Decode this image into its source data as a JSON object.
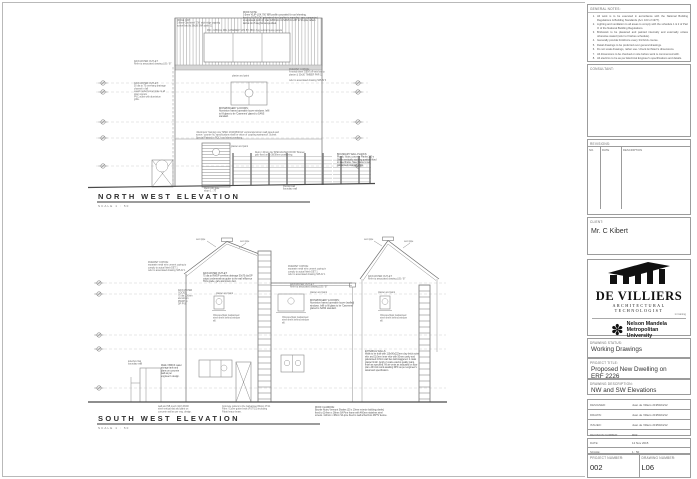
{
  "general_notes": {
    "title": "GENERAL NOTES:",
    "items": [
      "All work is to be executed in accordance with the National Building Regulations & Building Standards (Act. 103 of 1977).",
      "Lighting and ventilation to all areas to comply with the schedule 1 & 2 of Part O of the National Building Regulations.",
      "Brickwork to be plastered and painted internally and externally unless otherwise stated (refer to finishes schedule).",
      "Generally provide brickforce every 3rd brick course.",
      "Detail drawings to be preferred over general drawings.",
      "Do not scale drawings, rather use / check Architect's dimensions.",
      "All dimensions to be checked on site before work is commenced with.",
      "All electrics to be as per Electrical Engineer's specifications and details."
    ]
  },
  "consultant_label": "CONSULTANT:",
  "revisions": {
    "label": "REVISIONS:",
    "columns": [
      "NO.",
      "DATE",
      "DESCRIPTION"
    ]
  },
  "client": {
    "label": "CLIENT:",
    "name": "Mr. C Kibert"
  },
  "firm": {
    "name": "DE VILLIERS",
    "subtitle": "ARCHITECTURAL TECHNOLOGIST",
    "tagline": "in training"
  },
  "university": {
    "line1": "Nelson Mandela",
    "line2": "Metropolitan",
    "line3": "University",
    "motto": "for tomorrow",
    "icon": "flower-star"
  },
  "status": {
    "label": "DRAWING STATUS:",
    "value": "Working Drawings"
  },
  "project": {
    "label": "PROJECT TITLE:",
    "line1": "Proposed New Dwelling on",
    "line2": "ERF 2226"
  },
  "description": {
    "label": "DRAWING DESCRIPTION:",
    "value": "NW and SW Elevations"
  },
  "meta": {
    "designed_label": "DESIGNED:",
    "designed": "Juan de Villiers   2195024/12",
    "drawn_label": "DRAWN:",
    "drawn": "Juan de Villiers   2195024/12",
    "issued_label": "ISSUED:",
    "issued": "Juan de Villiers   2195024/12",
    "revnum_label": "REVISION NUMBER:",
    "revnum": "R02",
    "date_label": "DATE:",
    "date": "12 Nov 2015",
    "scale_label": "SCALE:",
    "scale": "1 : 50",
    "projnum_label": "PROJECT NUMBER:",
    "projnum": "002",
    "dwgnum_label": "DRAWING NUMBER:",
    "dwgnum": "L06"
  },
  "nw": {
    "title": "NORTH WEST ELEVATION",
    "scale": "SCALE 1 : 50"
  },
  "sw": {
    "title": "SOUTH WEST ELEVATION",
    "scale": "SCALE 1 : 50"
  },
  "drawing": {
    "labels": [
      {
        "x": 177,
        "y": 21,
        "lines": [
          "RIDGE CAP:",
          "0.6mm Galv steel 'CW' style ridge capping",
          "screw fixed to 38x38 SAP purlin 11"
        ]
      },
      {
        "x": 243,
        "y": 13,
        "b": true,
        "lines": [
          "ROOF NOTE:",
          "0.5mm 'KLIP-LOK 700' IBR profile concealed fix roof sheeting,",
          "fixed to 'KLIP-LOK' galvanised steel purlins to manufact. spec compacted",
          "to approved purlin @ max 1200mm crs SANS 10-237 to SA pine rafters",
          "laid at min 5 deg fall as specified."
        ]
      },
      {
        "x": 207,
        "y": 31,
        "lines": [
          "960 x 1850mm DBL CASEMENT W/1 BY 380m hng vertical louvre panels"
        ]
      },
      {
        "x": 134,
        "y": 62,
        "lines": [
          "RAIN WATER OUTLET:",
          "Refer to associated drawing L05 / 07"
        ]
      },
      {
        "x": 134,
        "y": 84,
        "lines": [
          "RAIN WATER OUTLET:",
          "50 dia to 75 overhang drainage",
          "channel in fall",
          "quard model funnel grate to all",
          "down spouts",
          "PVC outlet with aluminium",
          "grille."
        ]
      },
      {
        "x": 289,
        "y": 70,
        "lines": [
          "PARAPET COPING:",
          "A-metal sheet 'DEM' off-sets laid to",
          "plaster & 30x30 TIMBER PAR 11"
        ]
      },
      {
        "x": 289,
        "y": 81,
        "lines": [
          "refer to associated drawing S05-B/ 3"
        ]
      },
      {
        "x": 232,
        "y": 76.5,
        "lines": [
          "plaster and paint"
        ]
      },
      {
        "x": 219,
        "y": 109,
        "b": true,
        "lines": [
          "IRONMONGERY & DOORS:",
          "Aluminium framed openable louvre windows. Infill",
          "to fill glass to be 'Casement' glazed to SANS",
          "standard."
        ]
      },
      {
        "x": 196,
        "y": 133,
        "lines": [
          "'Aluminium' framing note 'SPEC 2010/08/2014' vertical aluminium wall panels and",
          "screw / counter fix, specifications shall be vision of coupling waterproof. Submit",
          "Special Painted in POLY roof sheet overhang."
        ]
      },
      {
        "x": 231,
        "y": 147,
        "lines": [
          "plaster and paint"
        ]
      },
      {
        "x": 255,
        "y": 153,
        "lines": [
          "Retro / 40mm dia 'SPECIALISED ROOF' Bousen",
          "galv fixed on to 38/38mm positioning."
        ]
      },
      {
        "x": 337,
        "y": 155,
        "b": true,
        "lines": [
          "BOUNDARY WALL PLANKS:",
          "Plumb, Nutec concrete Planks 100 x",
          "38mm vertically studding position fitted",
          "to steel frame. Steel frame to set",
          "galvanised retaining 2.0m."
        ]
      },
      {
        "x": 204,
        "y": 189,
        "lines": [
          "Mesh infill gate",
          "slope 1 : 75"
        ]
      },
      {
        "x": 283,
        "y": 187,
        "lines": [
          "precast wall",
          "boundary wall"
        ]
      },
      {
        "x": 148,
        "y": 263,
        "lines": [
          "PARAPET COPING:",
          "separate metal w/m cement coping to",
          "comply to actual finish DET 1",
          "refer to associated drawing S05-D/ 1"
        ]
      },
      {
        "x": 203,
        "y": 274,
        "b": true,
        "lines": [
          "RAIN WATER OUTLET:",
          "75 dia to RWDP overflow drainage 50x75 dia DP",
          "output underneath as gutter to the wall effluence",
          "SVG grade, galv aluminium duct."
        ]
      },
      {
        "x": 178,
        "y": 291,
        "lines": [
          "RAIN WATER",
          "GOODS:",
          "75 dia 100mm",
          "aluminium",
          "RWDP to",
          "DP PVC"
        ]
      },
      {
        "x": 196,
        "y": 240,
        "lines": [
          "vent pipe"
        ]
      },
      {
        "x": 240,
        "y": 242,
        "lines": [
          "vent pipe"
        ]
      },
      {
        "x": 364,
        "y": 240,
        "lines": [
          "vent pipe"
        ]
      },
      {
        "x": 404,
        "y": 242,
        "lines": [
          "vent pipe"
        ]
      },
      {
        "x": 288,
        "y": 267,
        "lines": [
          "PARAPET COPING:",
          "separate metal w/m cement coping in",
          "comply to actual finish DET 1",
          "refer to associated drawing S05-D/ 1"
        ]
      },
      {
        "x": 290,
        "y": 285,
        "lines": [
          "RAIN WATER OUTLET:",
          "Refer to associated drawing L05 / 07"
        ]
      },
      {
        "x": 368,
        "y": 277,
        "lines": [
          "RAIN WATER OUTLET:",
          "Refer to associated drawing L05 / 07"
        ]
      },
      {
        "x": 216,
        "y": 294,
        "lines": [
          "plaster and paint"
        ]
      },
      {
        "x": 310,
        "y": 293,
        "lines": [
          "plaster and paint"
        ]
      },
      {
        "x": 378,
        "y": 293,
        "lines": [
          "plaster and paint"
        ]
      },
      {
        "x": 310,
        "y": 301,
        "b": true,
        "lines": [
          "IRONMONGERY & DOORS:",
          "Aluminium framed openable louvre (walled)",
          "windows. Infill to fill glass to be 'Casement'",
          "glazed to SANS standard."
        ]
      },
      {
        "x": 213,
        "y": 316,
        "lines": [
          "Obscure/plain Galvanised",
          "steel sheet behind window",
          "sill."
        ]
      },
      {
        "x": 282,
        "y": 318,
        "lines": [
          "Obscure/plain Galvanised",
          "steel sheet behind window",
          "sill."
        ]
      },
      {
        "x": 380,
        "y": 316,
        "lines": [
          "Obscure/plain Galvanised",
          "steel sheet behind window",
          "sill."
        ]
      },
      {
        "x": 365,
        "y": 352,
        "b": true,
        "lines": [
          "EXTERNAL WALLS:",
          "Walls to be built with 110x90x222mm clay brick outer",
          "skin and 110mm inner skin with 50mm cavity and",
          "galvanised 2.8mm wall ties laid staggered. 2 coats",
          "plaster finish. Apply 2 coats exterior quality paint,",
          "finish as specified. All air vents as indicated on floor",
          "plan. All brick work awaiting DPC as per engineer's",
          "detail and specification."
        ]
      },
      {
        "x": 128,
        "y": 362,
        "lines": [
          "letterbox flag",
          "boundary wall"
        ]
      },
      {
        "x": 161,
        "y": 366,
        "b": true,
        "lines": [
          "Walls / BRICK water",
          "storage tank and",
          "plans on concrete",
          "wall as per",
          "engineer's design."
        ]
      },
      {
        "x": 222,
        "y": 407,
        "lines": [
          "Concrete gutters to the Galvanised Motor 47/11",
          "Fibre / Cover gutter beds (FGT/15) including",
          "Fibatt heavy beam."
        ]
      },
      {
        "x": 158,
        "y": 407,
        "lines": [
          "wall and NB mesh (110) PACK",
          "steel vertical slat and paint on",
          "concrete wall as per eng. design."
        ]
      },
      {
        "x": 315,
        "y": 408,
        "b": true,
        "lines": [
          "ROOF CLADDING:",
          "Bourke Nutec Vermont Shakes (20 x 10mm exterior building planks)",
          "fixed to 114mm x 38mm SA Pine frame with 460mm stainless steel",
          "screws. 114mm x 38mm SA pine fixed to wall w/Anchors 4B/TV device."
        ]
      }
    ],
    "level_lines": [
      {
        "x1": 96,
        "y": 83,
        "x2": 368
      },
      {
        "x1": 96,
        "y": 92,
        "x2": 368
      },
      {
        "x1": 96,
        "y": 122,
        "x2": 368
      },
      {
        "x1": 96,
        "y": 138,
        "x2": 368
      },
      {
        "x1": 96,
        "y": 166,
        "x2": 368
      },
      {
        "x1": 94,
        "y": 283,
        "x2": 446
      },
      {
        "x1": 94,
        "y": 294,
        "x2": 446
      },
      {
        "x1": 94,
        "y": 335,
        "x2": 446
      },
      {
        "x1": 94,
        "y": 349,
        "x2": 446
      },
      {
        "x1": 94,
        "y": 388,
        "x2": 446
      }
    ],
    "levels": [
      {
        "x": 103,
        "y": 83
      },
      {
        "x": 103,
        "y": 92
      },
      {
        "x": 103,
        "y": 122
      },
      {
        "x": 103,
        "y": 138
      },
      {
        "x": 103,
        "y": 166
      },
      {
        "x": 358,
        "y": 83
      },
      {
        "x": 358,
        "y": 92
      },
      {
        "x": 358,
        "y": 122
      },
      {
        "x": 358,
        "y": 138
      },
      {
        "x": 358,
        "y": 166
      },
      {
        "x": 99,
        "y": 283
      },
      {
        "x": 99,
        "y": 294
      },
      {
        "x": 99,
        "y": 335
      },
      {
        "x": 99,
        "y": 349
      },
      {
        "x": 99,
        "y": 388
      }
    ]
  }
}
